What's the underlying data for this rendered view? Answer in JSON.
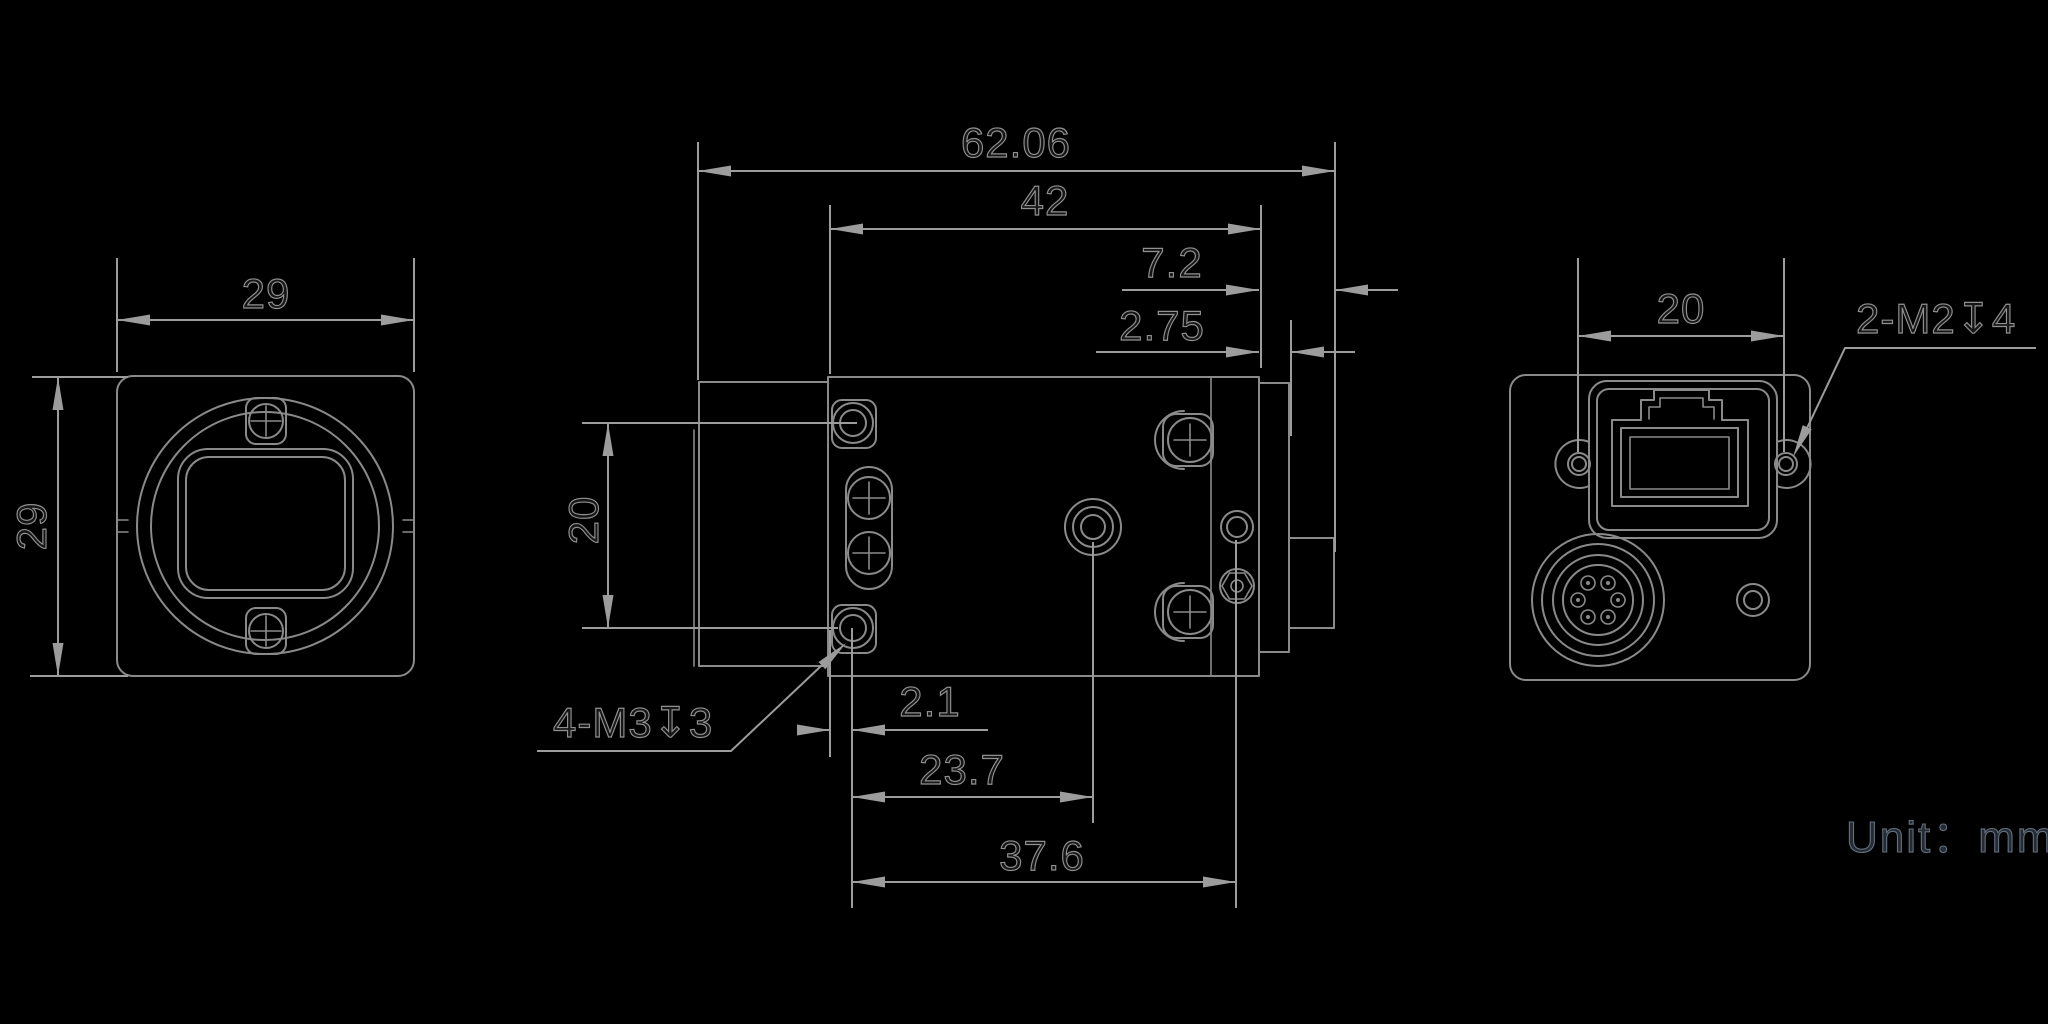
{
  "drawing": {
    "unit_note": "Unit：mm",
    "front_view": {
      "width_mm": "29",
      "height_mm": "29"
    },
    "side_view": {
      "total_length": "62.06",
      "body_length": "42",
      "rear_protrusion": "7.2",
      "rear_plate_thickness": "2.75",
      "mount_hole_spacing": "20",
      "front_hole_offset": "2.1",
      "tripod_hole_offset": "23.7",
      "rear_hole_offset": "37.6",
      "thread_callout": "4-M3↧3"
    },
    "back_view": {
      "screw_spacing": "20",
      "thread_callout": "2-M2↧4"
    }
  },
  "colors": {
    "background": "#000000",
    "geometry": "#8a8a8a",
    "dimension": "#9c9c9c",
    "text_fill": "#161616",
    "text_stroke": "#909090",
    "note_fill": "#232b34",
    "note_stroke": "#64707e"
  }
}
